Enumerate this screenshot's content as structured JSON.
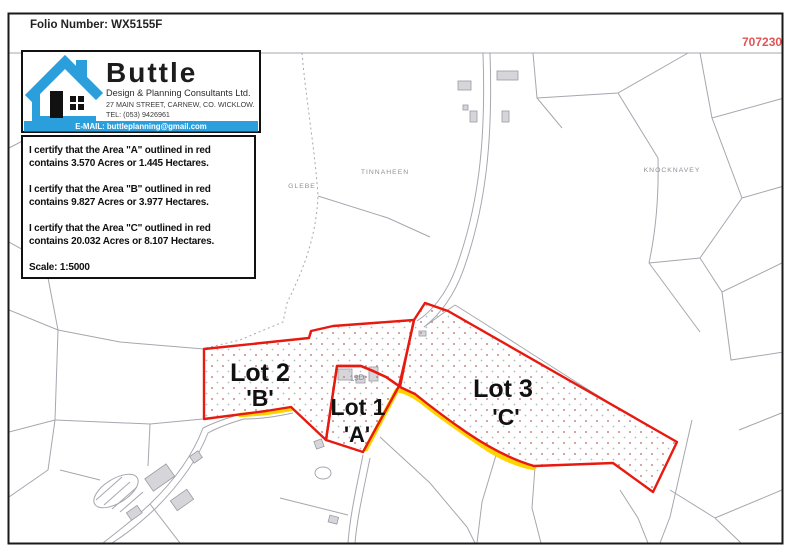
{
  "page": {
    "folio": "Folio Number: WX5155F",
    "grid_label": "707230"
  },
  "logo": {
    "name": "Buttle",
    "tagline": "Design & Planning Consultants Ltd.",
    "address": "27 MAIN STREET,  CARNEW,  CO. WICKLOW.",
    "tel": "TEL: (053) 9426961",
    "email": "E-MAIL: buttleplanning@gmail.com"
  },
  "certificate": {
    "entries": [
      {
        "line1": "I certify that the Area \"A\" outlined in red",
        "line2": "contains 3.570 Acres or 1.445 Hectares."
      },
      {
        "line1": "I certify that the Area \"B\" outlined in red",
        "line2": "contains 9.827 Acres or 3.977 Hectares."
      },
      {
        "line1": "I certify that the Area \"C\" outlined in red",
        "line2": "contains 20.032 Acres or 8.107 Hectares."
      }
    ],
    "scale": "Scale: 1:5000"
  },
  "map": {
    "lots": [
      {
        "name": "Lot 2",
        "letter": "'B'"
      },
      {
        "name": "Lot 1",
        "letter": "'A'"
      },
      {
        "name": "Lot 3",
        "letter": "'C'"
      }
    ],
    "townlands": [
      "TINNAHEEN",
      "GLEBE",
      "KNOCKNAVEY"
    ],
    "parcel_label": "13D",
    "colors": {
      "boundary_red": "#e8190f",
      "road_yellow": "#ffd400",
      "brand_blue": "#2b9fdc",
      "map_gray": "#a6a7af"
    }
  }
}
